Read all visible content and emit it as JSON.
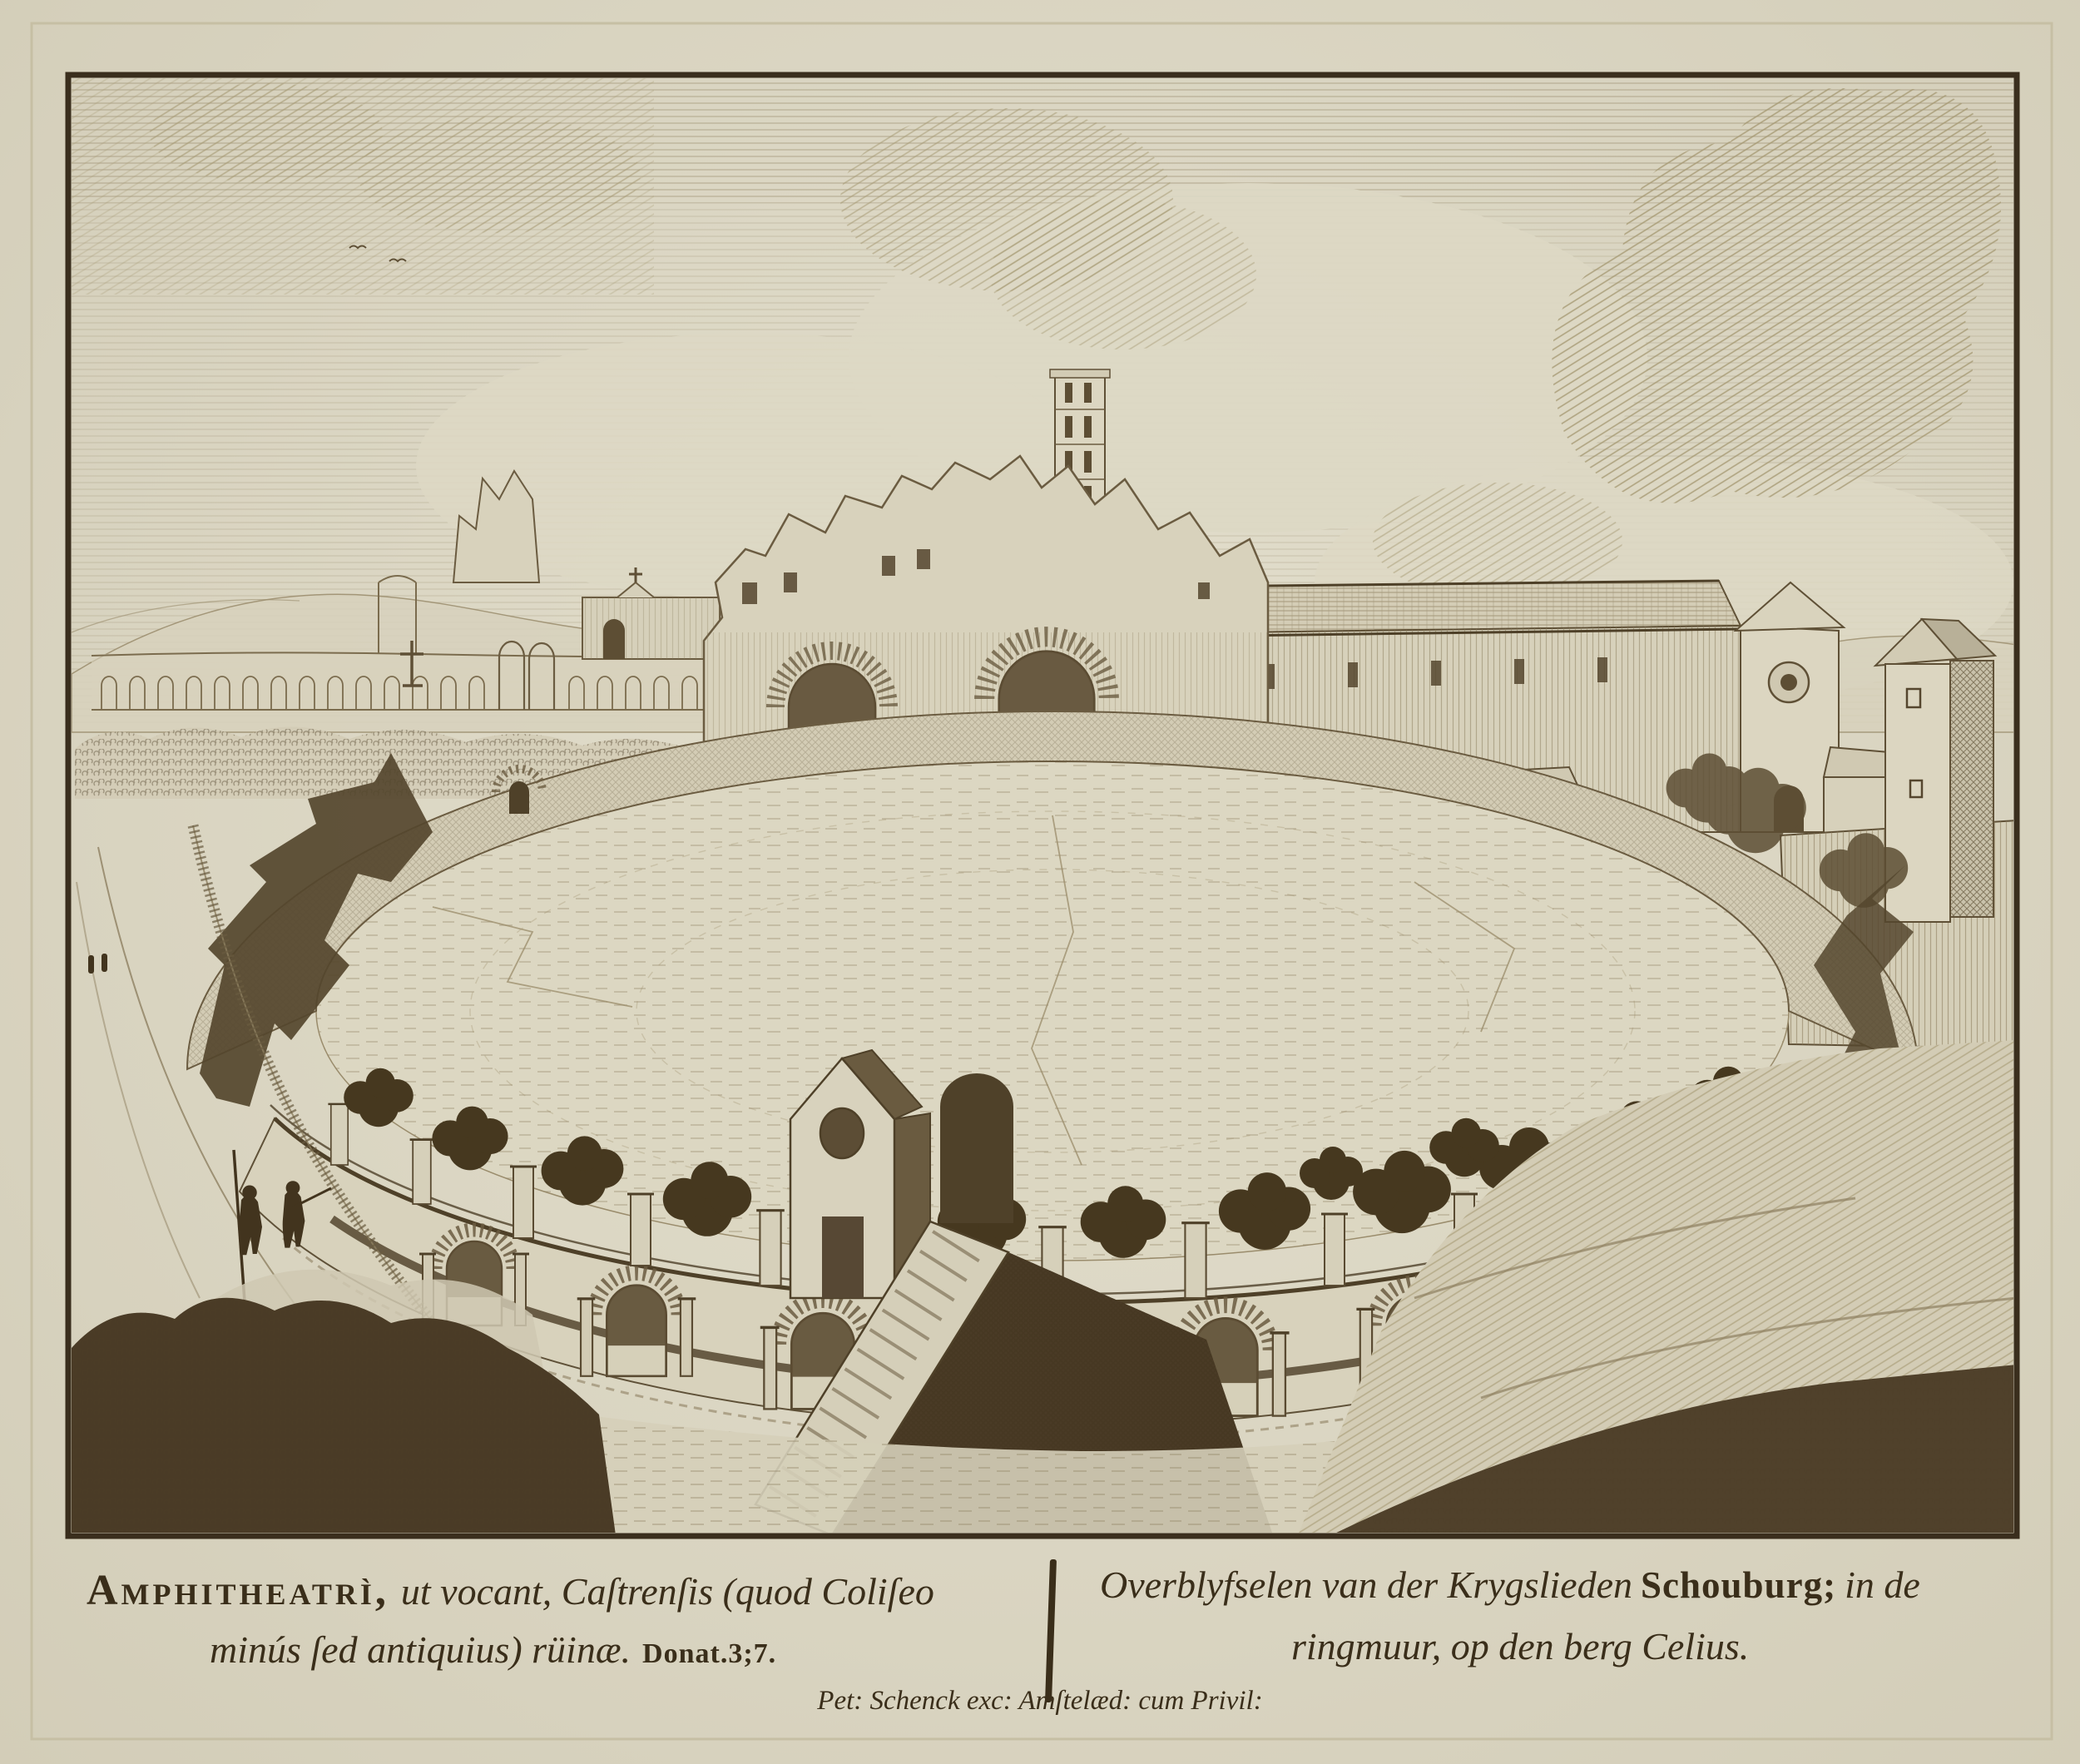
{
  "artwork": {
    "medium": "etching-print",
    "palette": {
      "paper": "#ddd8c4",
      "ink_dark": "#3b2f1d",
      "ink_mid": "#6b5c41",
      "ink_light": "#8d7f60",
      "wall_light": "#d8d2bc",
      "mass_dark": "#4a3b26"
    }
  },
  "captions": {
    "latin": {
      "lead": "Amphitheatrì,",
      "line1_rest": "ut vocant, Caſtrenſis (quod Coliſeo",
      "line2": "minús ſed antiquius) rüinæ.",
      "source_ref": "Donat.3;7."
    },
    "dutch": {
      "line1_a": "Overblyfselen van der Krygslieden",
      "highlight": "Schouburg;",
      "line1_b": "in de",
      "line2": "ringmuur, op den berg Celius."
    },
    "publisher": "Pet: Schenck exc: Amſtelæd: cum Privil:"
  }
}
